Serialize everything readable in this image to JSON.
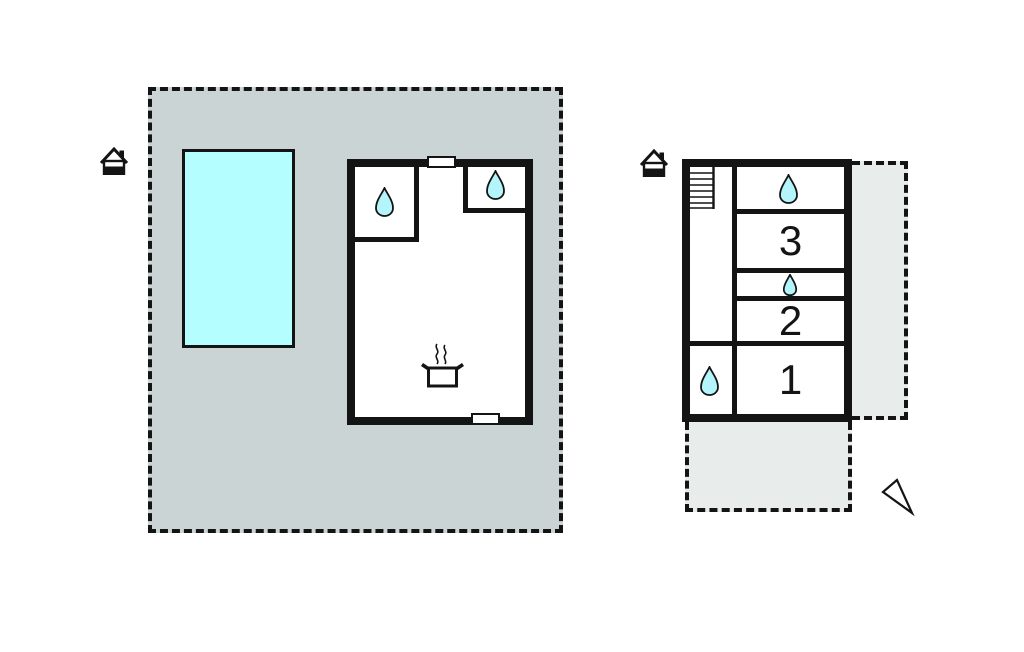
{
  "colors": {
    "background": "#ffffff",
    "outline": "#141414",
    "plot_fill": "#cbd4d4",
    "terrace_fill": "#e8edec",
    "pool_fill": "#b4feff",
    "drop_fill": "#b3f5fb"
  },
  "icons": {
    "house": "house-icon",
    "water_drop": "water-drop-icon",
    "cooking_pot": "cooking-pot-icon",
    "stairs": "stairs-icon",
    "north_arrow": "north-arrow-icon"
  },
  "rooms": {
    "room1_label": "1",
    "room2_label": "2",
    "room3_label": "3"
  }
}
